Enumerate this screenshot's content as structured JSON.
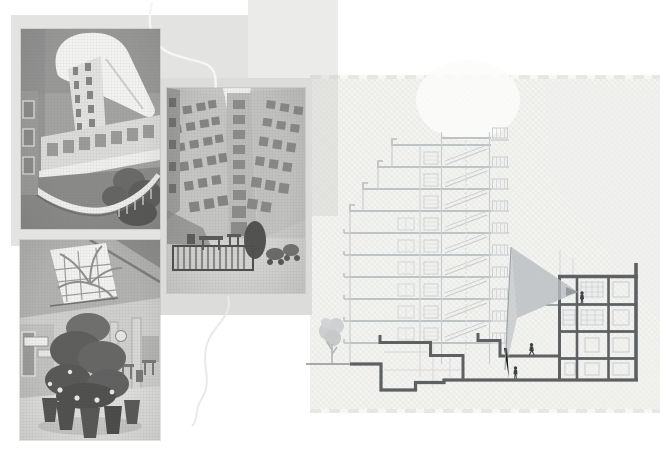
{
  "artboard": {
    "name": "architecture-collage-board",
    "width_px": 660,
    "height_px": 467,
    "background": "#ffffff"
  },
  "photos": [
    {
      "name": "courtyard-fisheye-photo",
      "description": "black and white upward fisheye view of a curved courtyard facade with gallery windows and a sweeping white parapet"
    },
    {
      "name": "lightwell-photo",
      "description": "black and white upward view of a narrow residential lightwell with window rows converging and a railed terrace with tables below"
    },
    {
      "name": "atrium-plants-photo",
      "description": "black and white interior view of a galleria atrium, potted plants in the middle under a bright skylight with palm fronds"
    }
  ],
  "section_drawing": {
    "name": "building-cross-section",
    "light_building_storeys": 10,
    "dark_building_storeys": 4,
    "human_figures": 3,
    "has_tree": true,
    "has_light-cone_triangle": true
  },
  "colors": {
    "paper": "#f4f4f2",
    "panel_a": "#e3e3e2",
    "panel_c": "#dcdcdb",
    "vertical_band": "#cecec9",
    "light_line": "#cbced0",
    "slab_line": "#c0c3c5",
    "dark_line": "#5d6164",
    "figure": "#3e4245",
    "triangle_light": "#c8cbcc",
    "triangle_mid": "#b9bdbf",
    "triangle_dark": "#a3a7a9",
    "tree": "#cbcdce",
    "squiggle_light": "#f6f6f5",
    "squiggle_grey": "#e9e9e7"
  }
}
